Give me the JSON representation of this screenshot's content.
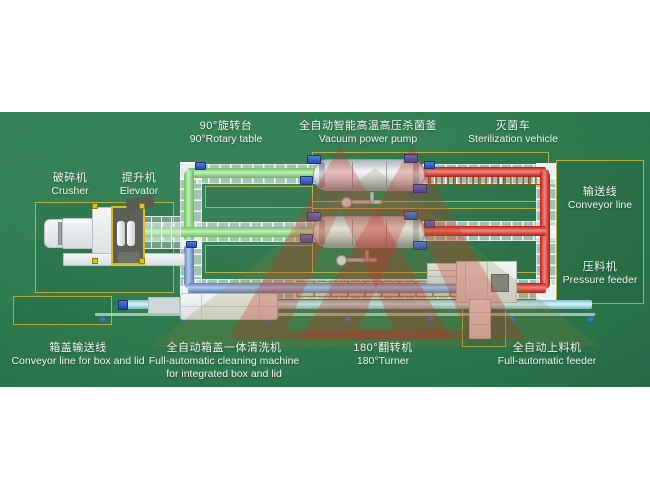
{
  "diagram": {
    "title_none": "",
    "labels": {
      "crusher": {
        "cn": "破碎机",
        "en": "Crusher"
      },
      "elevator": {
        "cn": "提升机",
        "en": "Elevator"
      },
      "rotary_table": {
        "cn": "90°旋转台",
        "en": "90°Rotary table"
      },
      "autoclave": {
        "cn": "全自动智能高温高压杀菌釜",
        "en": "Vacuum power pump"
      },
      "sterilization_vehicle": {
        "cn": "灭菌车",
        "en": "Sterilization vehicle"
      },
      "conveyor_line": {
        "cn": "输送线",
        "en": "Conveyor line"
      },
      "pressure_feeder": {
        "cn": "压料机",
        "en": "Pressure feeder"
      },
      "box_lid_conveyor": {
        "cn": "箱盖输送线",
        "en": "Conveyor line for box and lid"
      },
      "cleaning_machine": {
        "cn": "全自动箱盖一体清洗机",
        "en": "Full-automatic cleaning machine",
        "en2": "for integrated box and lid"
      },
      "turner": {
        "cn": "180°翻转机",
        "en": "180°Turner"
      },
      "feeder": {
        "cn": "全自动上料机",
        "en": "Full-automatic feeder"
      }
    }
  },
  "colors": {
    "background_green": "#2e7b4e",
    "conveyor_green": "#86ec78",
    "conveyor_red": "#e81d0e",
    "conveyor_blue": "#6f9be8",
    "conveyor_cyan": "#a9edfa",
    "zone_outline": "rgba(206,184,62,0.85)",
    "cart_orange": "#ef9a10",
    "pallet_beige": "#d8c7a0",
    "watermark_red": "#c8271d",
    "watermark_khaki": "#8d7b2f",
    "label_white": "#f5f7f5"
  }
}
